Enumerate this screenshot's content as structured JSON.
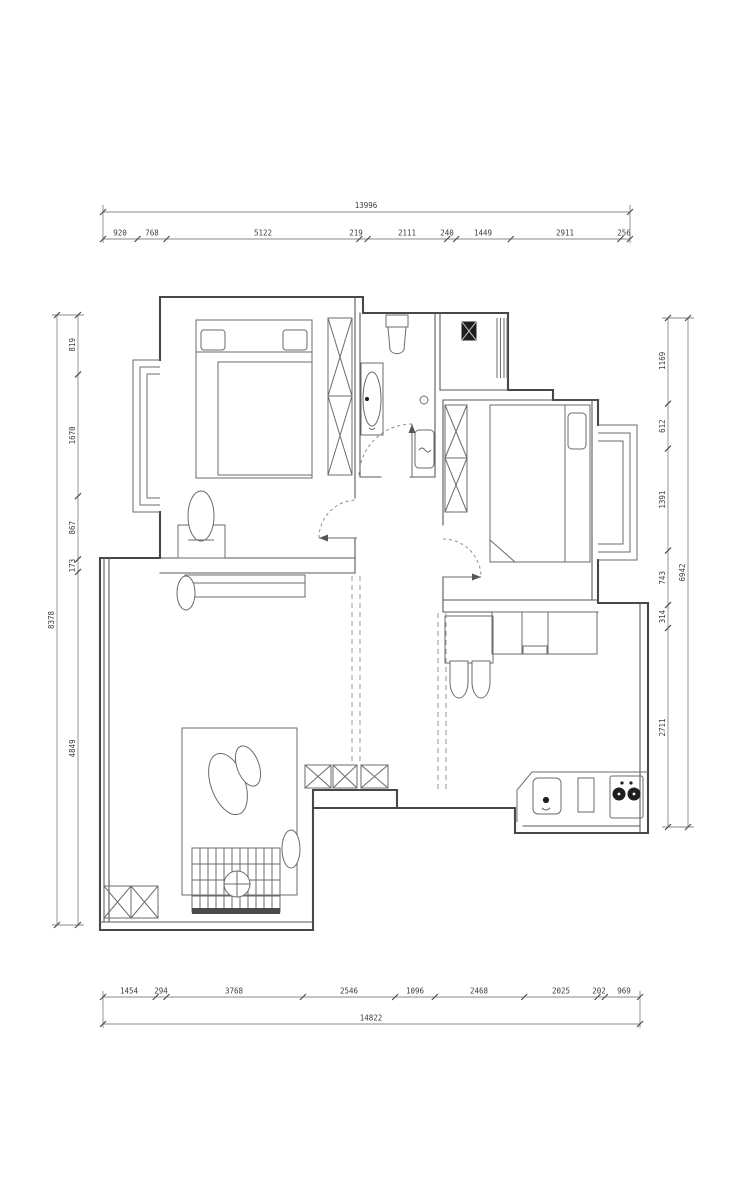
{
  "drawing": {
    "type": "apartment-floor-plan",
    "background": "#ffffff",
    "wall_color": "#474747",
    "furniture_color": "#6b6b6b",
    "dimension_color": "#8a8a8a"
  },
  "dimensions": {
    "top": {
      "total": "13996",
      "segments": [
        "920",
        "768",
        "5122",
        "219",
        "2111",
        "240",
        "1449",
        "2911",
        "256"
      ]
    },
    "bottom": {
      "total": "14822",
      "segments": [
        "1454",
        "294",
        "3768",
        "2546",
        "1096",
        "2468",
        "2025",
        "202",
        "969"
      ]
    },
    "left": {
      "total": "8378",
      "segments": [
        "819",
        "1670",
        "867",
        "173",
        "4849"
      ]
    },
    "right": {
      "total": "6942",
      "segments": [
        "1169",
        "612",
        "1391",
        "743",
        "314",
        "2711"
      ]
    }
  },
  "symbols": {
    "rooms": [
      "bedroom-1",
      "bathroom",
      "utility-balcony",
      "bedroom-2",
      "living-room",
      "dining-area",
      "kitchen"
    ],
    "furniture": [
      "double-bed",
      "wardrobe-x-hatch",
      "dressing-table",
      "stool",
      "toilet",
      "washbasin",
      "floor-drain",
      "washing-machine",
      "water-heater",
      "single-bed",
      "sideboard",
      "plant",
      "rug",
      "floor-lamp",
      "daybed-grid",
      "round-table",
      "tv-console-x-hatch",
      "corner-cabinet-x-hatch",
      "dining-table",
      "dining-chairs",
      "kitchen-counter",
      "sink",
      "gas-stove"
    ],
    "openings": [
      "door-swing-bedroom-1",
      "door-swing-bathroom",
      "door-swing-bedroom-2",
      "bay-window-left",
      "bay-window-right",
      "window-strip-living",
      "window-slats-utility"
    ]
  }
}
